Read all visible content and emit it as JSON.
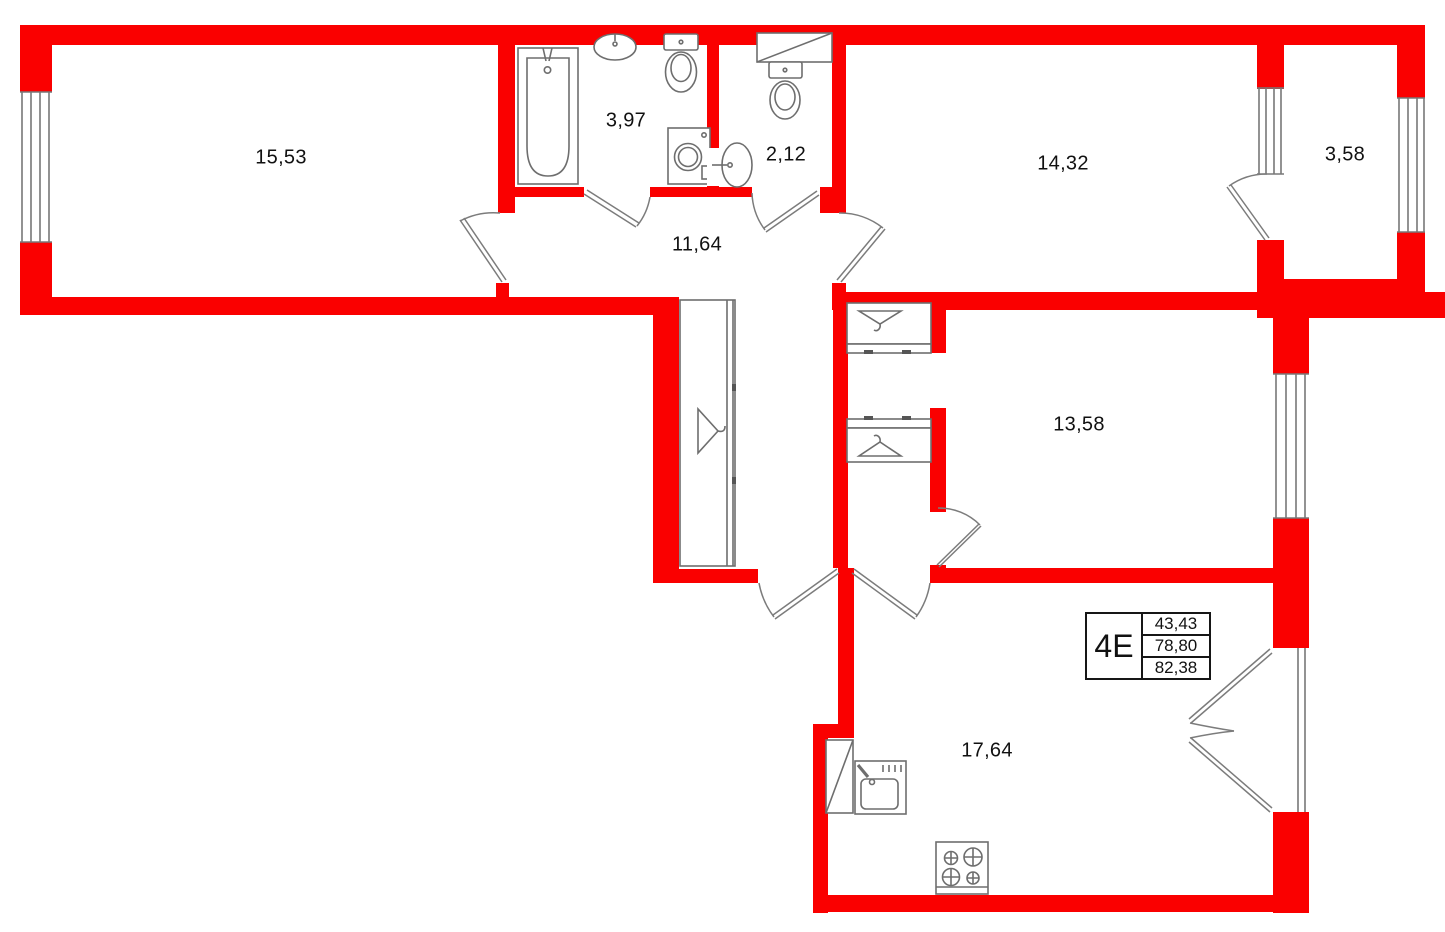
{
  "plan": {
    "unit": {
      "label": "4E",
      "values": [
        "43,43",
        "78,80",
        "82,38"
      ]
    },
    "rooms": [
      {
        "name": "room-top-left",
        "area": "15,53"
      },
      {
        "name": "bathroom",
        "area": "3,97"
      },
      {
        "name": "wc",
        "area": "2,12"
      },
      {
        "name": "room-top-right",
        "area": "14,32"
      },
      {
        "name": "balcony",
        "area": "3,58"
      },
      {
        "name": "hallway",
        "area": "11,64"
      },
      {
        "name": "room-middle-right",
        "area": "13,58"
      },
      {
        "name": "kitchen-living",
        "area": "17,64"
      }
    ],
    "colors": {
      "wall": "#fa0000",
      "fixture_line": "#6e6e6e",
      "door_line": "#7c7c7c",
      "text": "#111111"
    },
    "icons": [
      "bathtub-icon",
      "bathroom-sink-icon",
      "bathroom-toilet-icon",
      "washing-machine-icon",
      "wc-shelf-icon",
      "wc-toilet-icon",
      "wc-sink-icon",
      "corridor-wardrobe-icon",
      "hanger-icon",
      "closet-icon",
      "kitchen-tall-cabinet-icon",
      "kitchen-sink-icon",
      "stove-icon",
      "window-icon",
      "door-swing-icon"
    ]
  }
}
